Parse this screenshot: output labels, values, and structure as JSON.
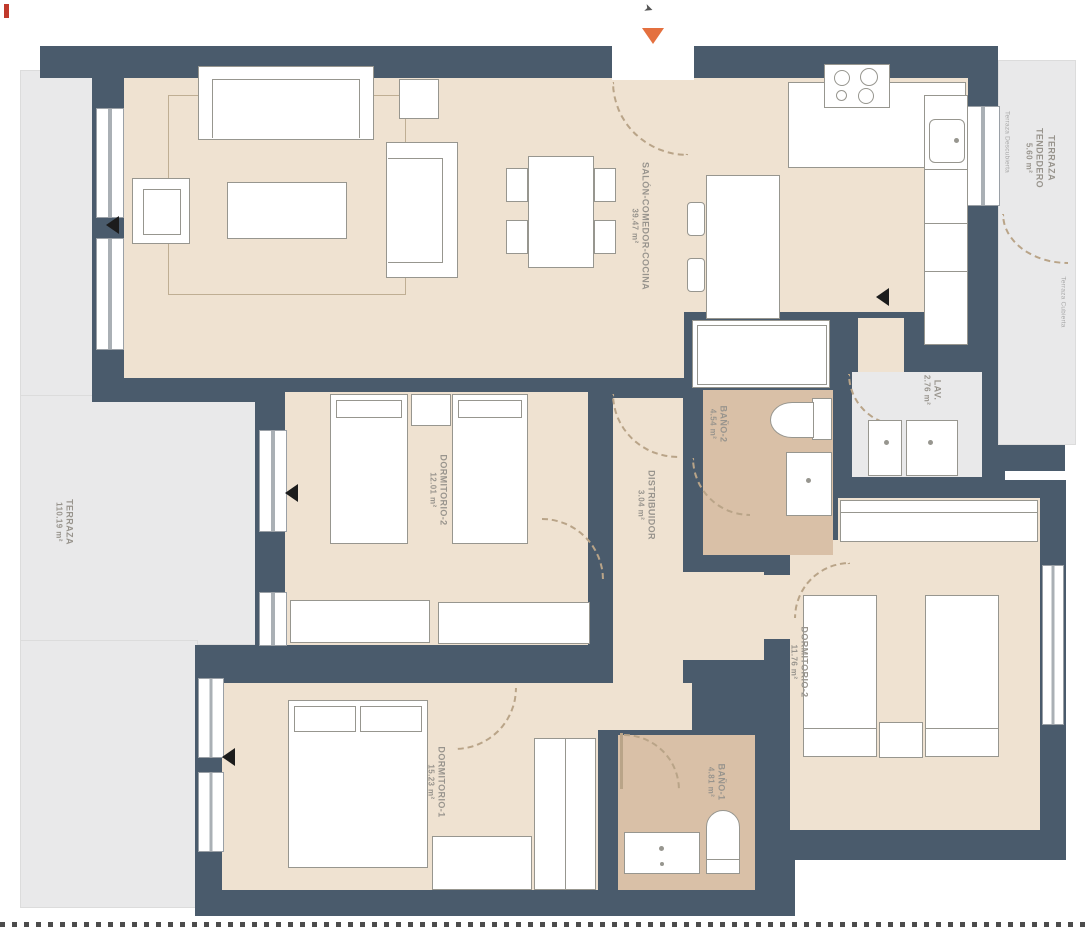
{
  "plan": {
    "entrance": {
      "direction_icon": "➤"
    },
    "rooms": [
      {
        "name": "SALÓN-COMEDOR-COCINA",
        "area": "39.47 m²"
      },
      {
        "name": "DORMITORIO-2",
        "area": "12.01 m²"
      },
      {
        "name": "DISTRIBUIDOR",
        "area": "3.04 m²"
      },
      {
        "name": "BAÑO-2",
        "area": "4.54 m²"
      },
      {
        "name": "DORMITORIO-2",
        "area": "11.76 m²"
      },
      {
        "name": "DORMITORIO-1",
        "area": "15.23 m²"
      },
      {
        "name": "BAÑO-1",
        "area": "4.81 m²"
      },
      {
        "name": "LAV.",
        "area": "2.76 m²"
      },
      {
        "name": "TERRAZA",
        "area": "110.19 m²"
      },
      {
        "name": "TERRAZA TENDEDERO",
        "area": "5.60 m²"
      }
    ],
    "annotations": [
      {
        "label": "Terraza Descubierta"
      },
      {
        "label": "Terraza Cubierta"
      }
    ],
    "colors": {
      "wall": "#4a5b6c",
      "floor": "#efe2d1",
      "bathroom_floor": "#d9c0a7",
      "terrace": "#e9e9ea",
      "furniture_outline": "#97968f",
      "label_text": "#98948d",
      "entrance_marker": "#e4703f"
    }
  }
}
